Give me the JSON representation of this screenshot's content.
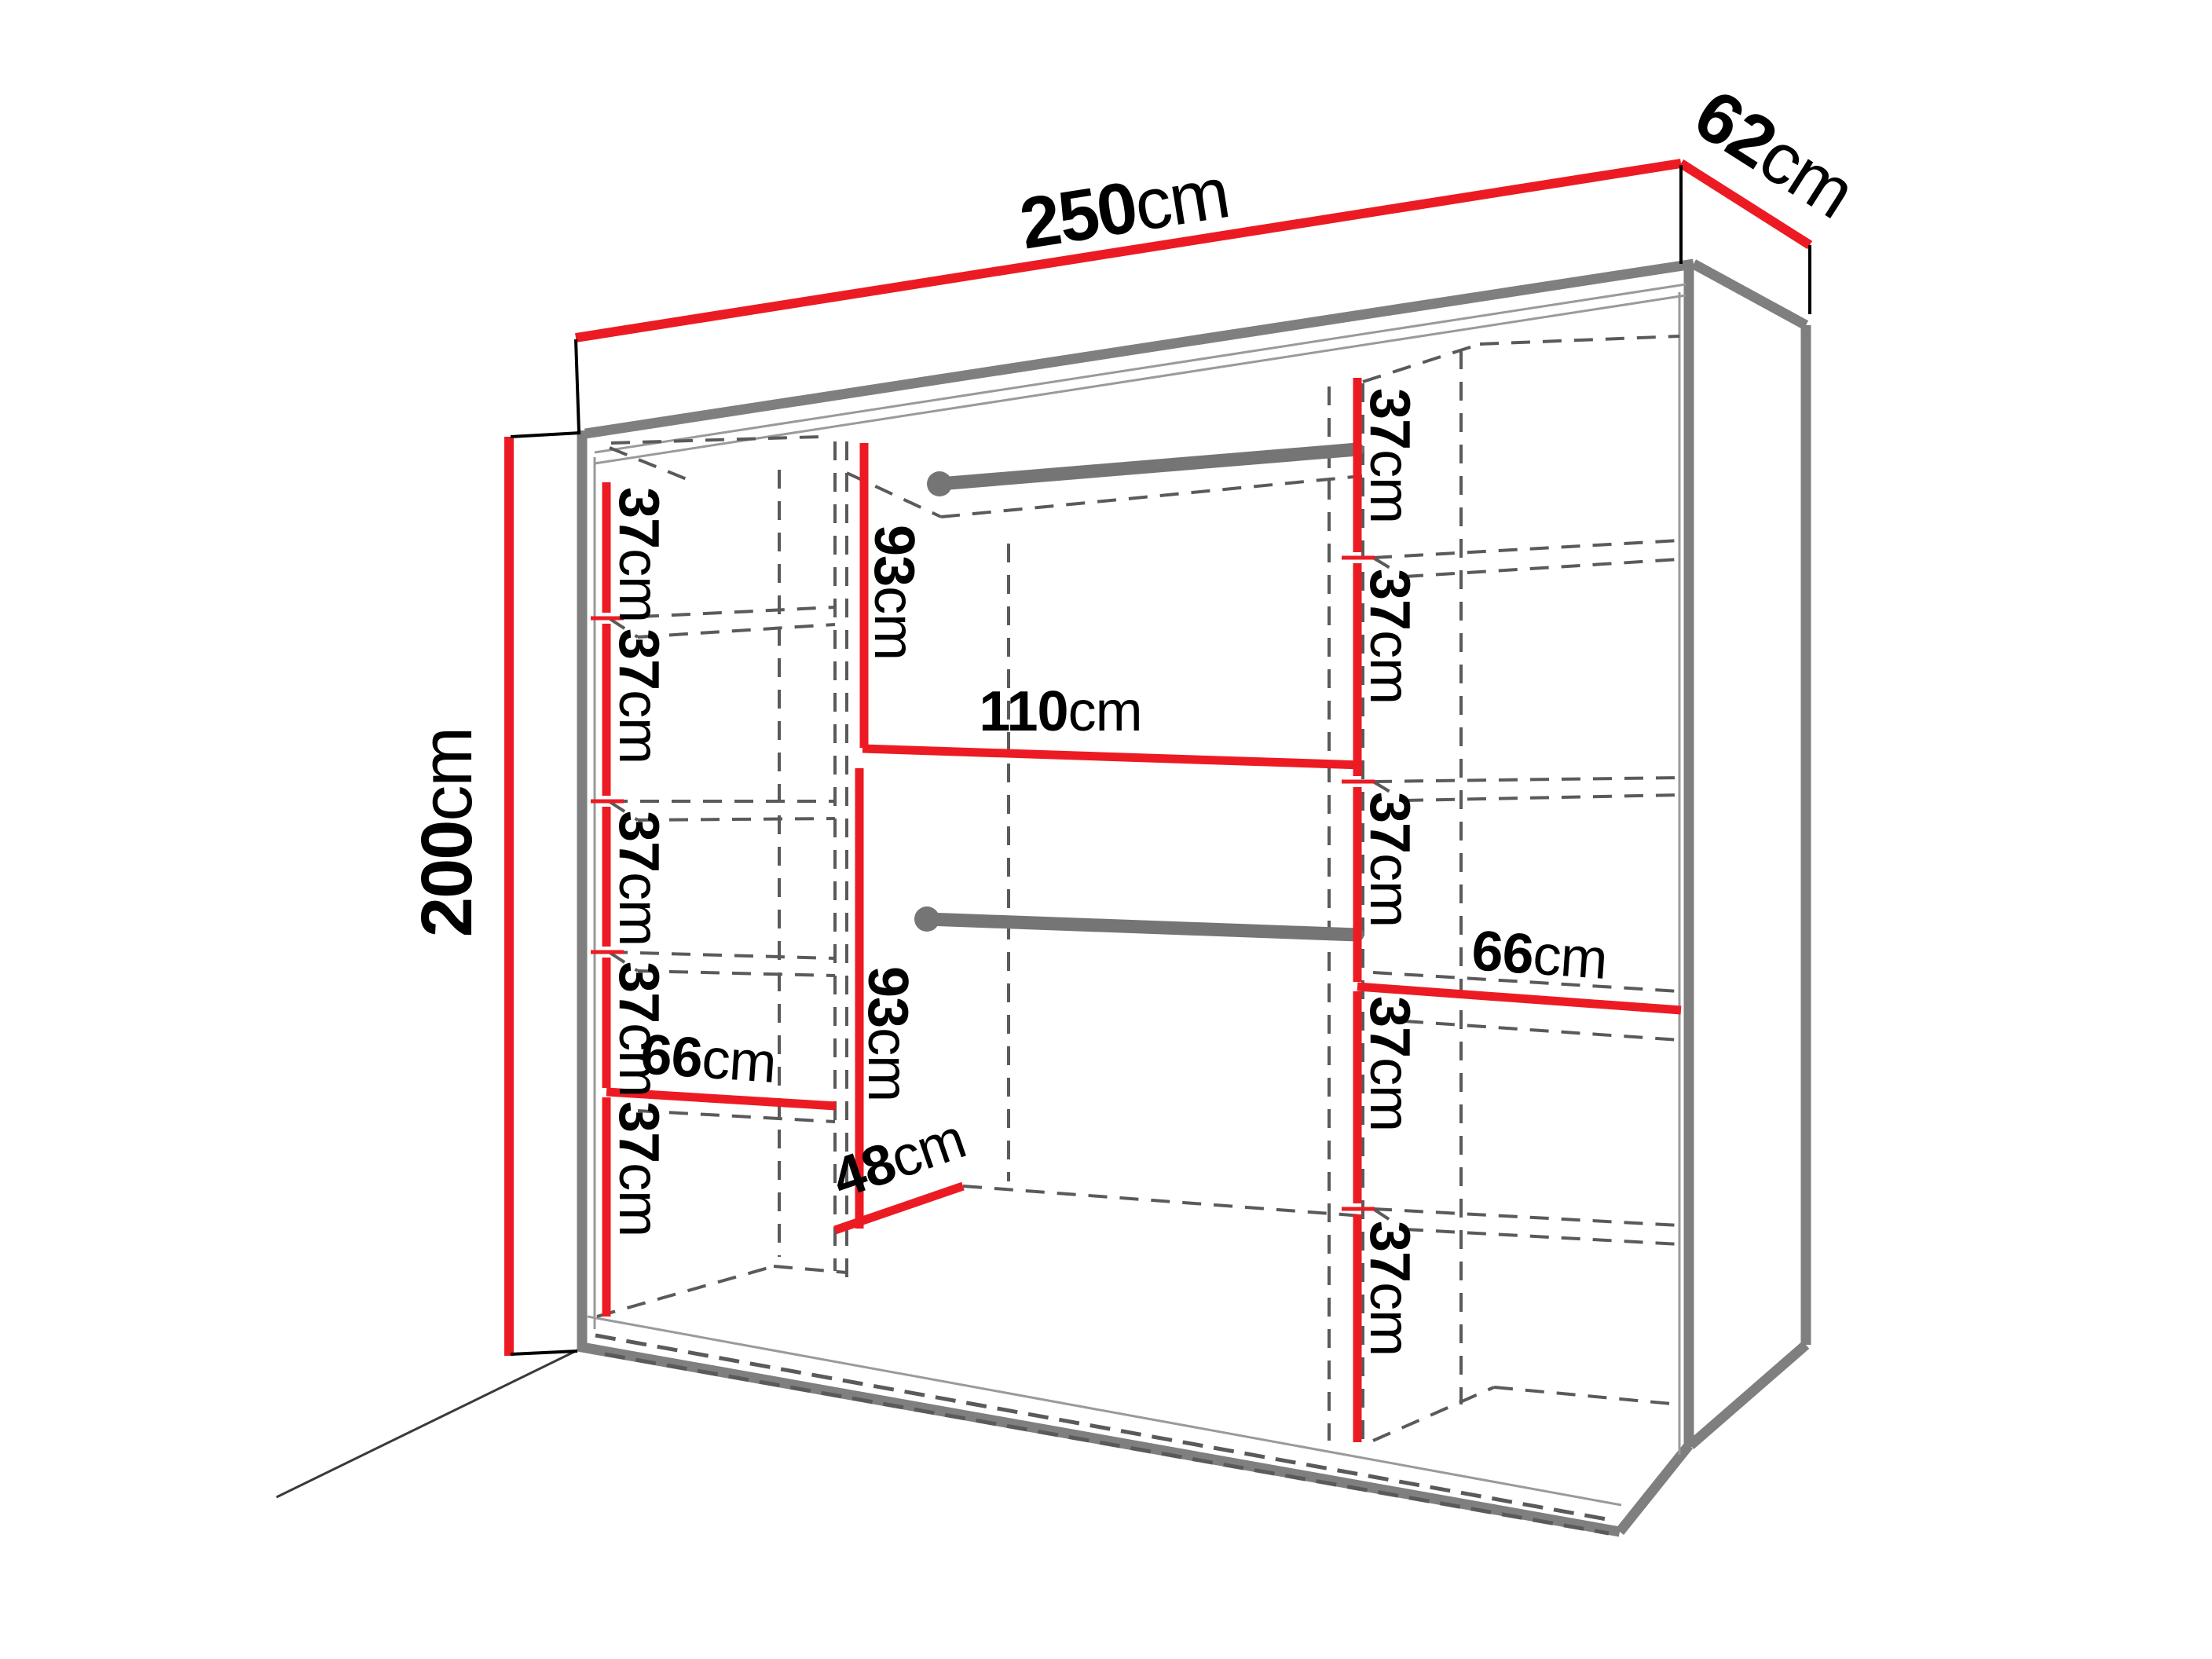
{
  "diagram": {
    "type": "furniture-dimension-diagram",
    "subject": "wardrobe perspective drawing with interior shelf and rail dimensions",
    "unit": "cm",
    "colors": {
      "dimension_line": "#ec1b23",
      "outline": "#7f7f7f",
      "hidden_edge": "#5a5a5a",
      "rail": "#757575",
      "text": "#000000",
      "background": "#ffffff"
    },
    "overall_dimensions": {
      "width_cm": 250,
      "depth_cm": 62,
      "height_cm": 200
    },
    "labels": {
      "width": {
        "value": "250",
        "unit": "cm"
      },
      "depth": {
        "value": "62",
        "unit": "cm"
      },
      "height": {
        "value": "200",
        "unit": "cm"
      },
      "left_shelf_1": {
        "value": "37",
        "unit": "cm"
      },
      "left_shelf_2": {
        "value": "37",
        "unit": "cm"
      },
      "left_shelf_3": {
        "value": "37",
        "unit": "cm"
      },
      "left_shelf_4": {
        "value": "37",
        "unit": "cm"
      },
      "left_shelf_5": {
        "value": "37",
        "unit": "cm"
      },
      "left_section_width": {
        "value": "66",
        "unit": "cm"
      },
      "center_top_height": {
        "value": "93",
        "unit": "cm"
      },
      "center_width": {
        "value": "110",
        "unit": "cm"
      },
      "center_bottom_height": {
        "value": "93",
        "unit": "cm"
      },
      "center_depth": {
        "value": "48",
        "unit": "cm"
      },
      "right_shelf_1": {
        "value": "37",
        "unit": "cm"
      },
      "right_shelf_2": {
        "value": "37",
        "unit": "cm"
      },
      "right_shelf_3": {
        "value": "37",
        "unit": "cm"
      },
      "right_shelf_4": {
        "value": "37",
        "unit": "cm"
      },
      "right_shelf_5": {
        "value": "37",
        "unit": "cm"
      },
      "right_section_width": {
        "value": "66",
        "unit": "cm"
      }
    }
  }
}
